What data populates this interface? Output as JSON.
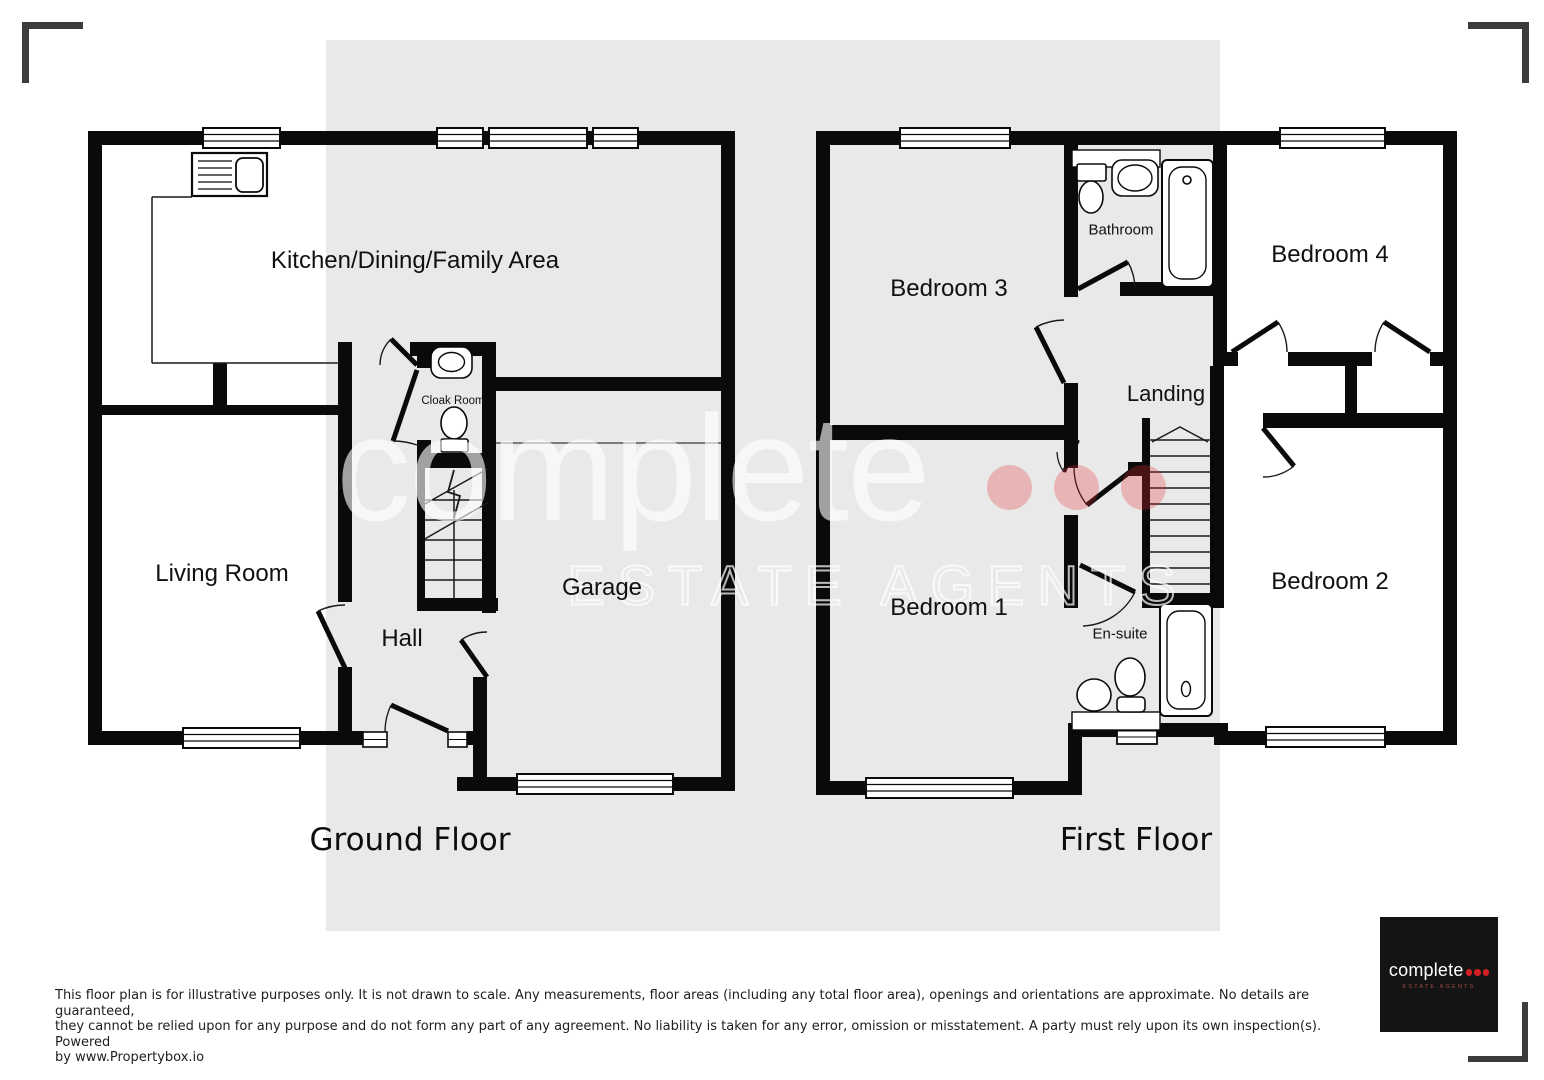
{
  "ground": {
    "title": "Ground Floor",
    "kitchen": "Kitchen/Dining/Family Area",
    "living": "Living Room",
    "hall": "Hall",
    "cloak": "Cloak Room",
    "garage": "Garage"
  },
  "first": {
    "title": "First Floor",
    "bed1": "Bedroom 1",
    "bed2": "Bedroom 2",
    "bed3": "Bedroom 3",
    "bed4": "Bedroom 4",
    "bathroom": "Bathroom",
    "ensuite": "En-suite",
    "landing": "Landing"
  },
  "watermark": {
    "brand": "complete",
    "tagline": "ESTATE AGENTS",
    "dot_color": "#e12d32"
  },
  "logo": {
    "brand": "complete",
    "tagline": "ESTATE AGENTS",
    "dot_color": "#d42027",
    "bg_color": "#141414"
  },
  "footer": {
    "line1": "This floor plan is for illustrative purposes only. It is not drawn to scale. Any measurements, floor areas (including any total floor area), openings and orientations are approximate. No details are guaranteed,",
    "line2": "they cannot be relied upon for any purpose and do not form any part of any agreement. No liability is taken for any error, omission or misstatement. A party must rely upon its own inspection(s). Powered",
    "line3": "by www.Propertybox.io"
  },
  "colors": {
    "wall": "#0a0a0a",
    "band": "#e9e9e9"
  }
}
